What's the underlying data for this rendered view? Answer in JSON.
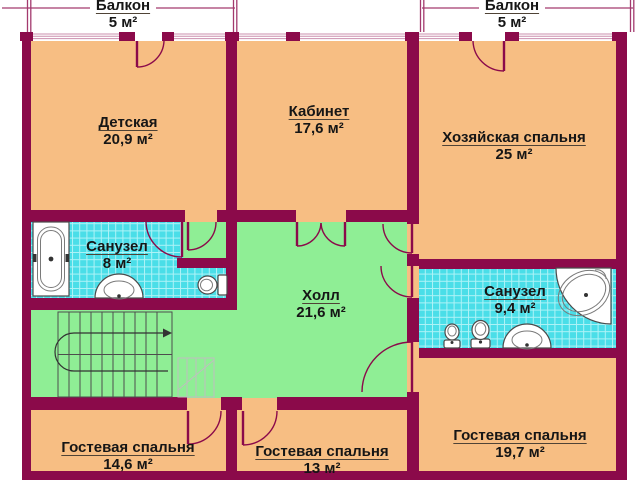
{
  "plan": {
    "title": "Floor plan",
    "rooms": {
      "balcony_left": {
        "name": "Балкон",
        "area": "5 м²"
      },
      "balcony_right": {
        "name": "Балкон",
        "area": "5 м²"
      },
      "nursery": {
        "name": "Детская",
        "area": "20,9 м²"
      },
      "office": {
        "name": "Кабинет",
        "area": "17,6 м²"
      },
      "master_bedroom": {
        "name": "Хозяйская спальня",
        "area": "25 м²"
      },
      "bathroom_left": {
        "name": "Санузел",
        "area": "8 м²"
      },
      "hall": {
        "name": "Холл",
        "area": "21,6 м²"
      },
      "bathroom_right": {
        "name": "Санузел",
        "area": "9,4 м²"
      },
      "guest_bedroom_left": {
        "name": "Гостевая спальня",
        "area": "14,6 м²"
      },
      "guest_bedroom_middle": {
        "name": "Гостевая спальня",
        "area": "13 м²"
      },
      "guest_bedroom_right": {
        "name": "Гостевая спальня",
        "area": "19,7 м²"
      }
    },
    "colors": {
      "wall": "#8B0A4A",
      "room": "#F7BE83",
      "hall": "#8FEE95",
      "tile": "#4ADEE8",
      "tileline": "#AFF3F7"
    }
  }
}
